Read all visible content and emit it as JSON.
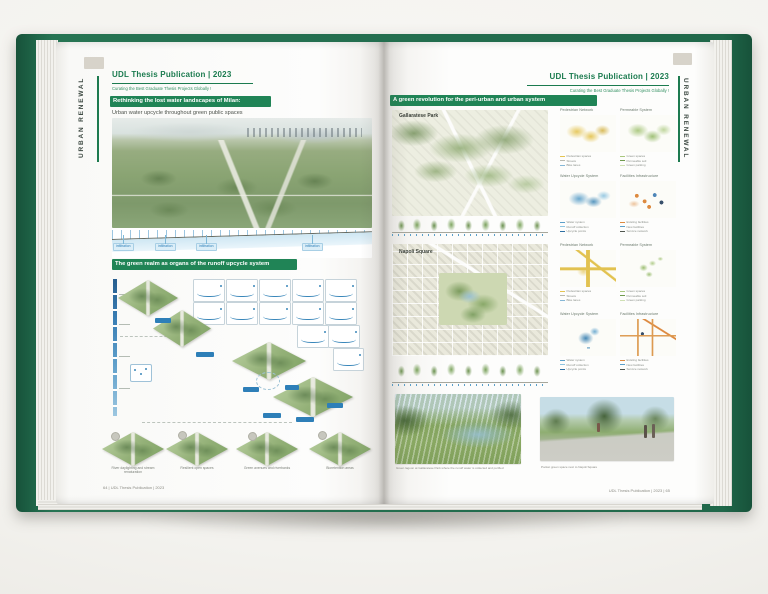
{
  "colors": {
    "cover_green": "#20684a",
    "banner_green": "#208456",
    "title_green": "#1b7b4f",
    "water_blue": "#4f9bc8",
    "pedestrian_yellow": "#e4c452",
    "permeable_green": "#a9c77e",
    "facilities_orange": "#dd8a40"
  },
  "left_page": {
    "spine_label": "URBAN RENEWAL",
    "header": {
      "title": "UDL Thesis Publication | 2023",
      "subtitle": "Curating the Best Graduate Thesis Projects Globally !"
    },
    "title_banner": "Rethinking the lost water landscapes of Milan:",
    "intro_line": "Urban water upcycle throughout green public spaces",
    "section_labels": [
      "infiltration",
      "infiltration",
      "infiltration",
      "infiltration"
    ],
    "system_banner": "The green realm as organs of the runoff upcycle system",
    "strategy_tiles": [
      {
        "caption": "River daylighting and stream renaturation"
      },
      {
        "caption": "Resilient open spaces"
      },
      {
        "caption": "Green avenues and riverbanks"
      },
      {
        "caption": "Bioretention areas"
      }
    ],
    "footer": "64 | UDL Thesis Publication | 2023"
  },
  "right_page": {
    "spine_label": "URBAN RENEWAL",
    "header": {
      "title": "UDL Thesis Publication | 2023",
      "subtitle": "Curating the Best Graduate Thesis Projects Globally !"
    },
    "title_banner": "A green revolution for the peri-urban and urban system",
    "site_maps": [
      {
        "label": "Gallaratese Park"
      },
      {
        "label": "Napoli Square"
      }
    ],
    "analysis_groups": [
      {
        "site": "Gallaratese Park",
        "maps": [
          {
            "title": "Pedestrian Network",
            "legend": [
              {
                "color": "#e4c452",
                "label": "Pedestrian spaces"
              },
              {
                "color": "#b9b9af",
                "label": "Streets"
              },
              {
                "color": "#86b7d6",
                "label": "Bike lanes"
              }
            ]
          },
          {
            "title": "Permeable System",
            "legend": [
              {
                "color": "#a9c77e",
                "label": "Green spaces"
              },
              {
                "color": "#6f9a4e",
                "label": "Permeable soil"
              },
              {
                "color": "#cfe0b4",
                "label": "Green parking"
              }
            ]
          },
          {
            "title": "Water Upcycle System",
            "legend": [
              {
                "color": "#5b9fc9",
                "label": "Water system"
              },
              {
                "color": "#8fc4e0",
                "label": "Runoff collection"
              },
              {
                "color": "#2e6fa3",
                "label": "Upcycle points"
              }
            ]
          },
          {
            "title": "Facilities  Infrastructure",
            "legend": [
              {
                "color": "#dd8a40",
                "label": "Existing facilities"
              },
              {
                "color": "#5b9fc9",
                "label": "New facilities"
              },
              {
                "color": "#50564f",
                "label": "Service network"
              }
            ]
          }
        ]
      },
      {
        "site": "Napoli Square",
        "maps": [
          {
            "title": "Pedestrian Network",
            "legend": [
              {
                "color": "#e4c452",
                "label": "Pedestrian spaces"
              },
              {
                "color": "#b9b9af",
                "label": "Streets"
              },
              {
                "color": "#86b7d6",
                "label": "Bike lanes"
              }
            ]
          },
          {
            "title": "Permeable System",
            "legend": [
              {
                "color": "#a9c77e",
                "label": "Green spaces"
              },
              {
                "color": "#6f9a4e",
                "label": "Permeable soil"
              },
              {
                "color": "#cfe0b4",
                "label": "Green parking"
              }
            ]
          },
          {
            "title": "Water Upcycle System",
            "legend": [
              {
                "color": "#5b9fc9",
                "label": "Water system"
              },
              {
                "color": "#8fc4e0",
                "label": "Runoff collection"
              },
              {
                "color": "#2e6fa3",
                "label": "Upcycle points"
              }
            ]
          },
          {
            "title": "Facilities  Infrastructure",
            "legend": [
              {
                "color": "#dd8a40",
                "label": "Existing facilities"
              },
              {
                "color": "#5b9fc9",
                "label": "New facilities"
              },
              {
                "color": "#50564f",
                "label": "Service network"
              }
            ]
          }
        ]
      }
    ],
    "renders": [
      {
        "caption": "Green lagoon at Gallaratese Park where the runoff water is collected and purified"
      },
      {
        "caption": "Pocket green space next to Napoli Square"
      }
    ],
    "footer": "UDL Thesis Publication | 2023 | 65"
  }
}
